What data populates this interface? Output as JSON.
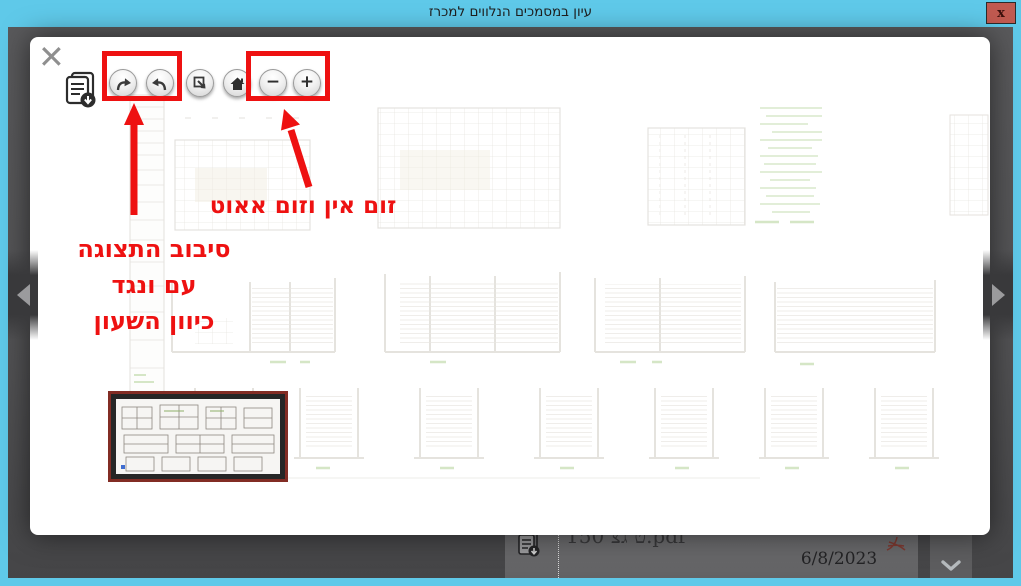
{
  "titlebar": {
    "title": "עיון במסמכים הנלווים למכרז",
    "close_label": "x"
  },
  "modal": {
    "close_icon": "✕",
    "toolbar": {
      "download_icon": "document-download-icon",
      "buttons": [
        {
          "id": "rotate-clockwise",
          "icon": "rotate-clockwise-icon"
        },
        {
          "id": "rotate-counterclockwise",
          "icon": "rotate-counterclockwise-icon"
        },
        {
          "id": "fit-to-screen",
          "icon": "resize-icon"
        },
        {
          "id": "home",
          "icon": "home-icon"
        },
        {
          "id": "zoom-out",
          "icon": "minus-icon",
          "glyph": "−"
        },
        {
          "id": "zoom-in",
          "icon": "plus-icon",
          "glyph": "+"
        }
      ]
    },
    "annotations": {
      "color": "#ee1111",
      "zoom_label": "זום אין וזום אאוט",
      "rotate_label_line1": "סיבוב התצוגה",
      "rotate_label_line2": "עם ונגד",
      "rotate_label_line3": "כיוון השעון"
    },
    "content": "faded architectural floor-plan and elevation sheet",
    "thumbnail": "page-1-thumbnail"
  },
  "nav": {
    "prev_icon": "chevron-left-icon",
    "next_icon": "chevron-right-icon"
  },
  "document_row": {
    "file_name": "150 ט גצ.pdf",
    "date": "6/8/2023",
    "doc_icon": "document-download-icon",
    "pdf_icon": "pdf-file-icon",
    "scroll_icon": "chevron-down-icon"
  },
  "colors": {
    "titlebar_bg": "#5fc9e9",
    "annotation_red": "#ee1111",
    "close_button_bg": "#c05a50",
    "thumbnail_border": "#822c24",
    "overlay_bg": "#515153"
  }
}
